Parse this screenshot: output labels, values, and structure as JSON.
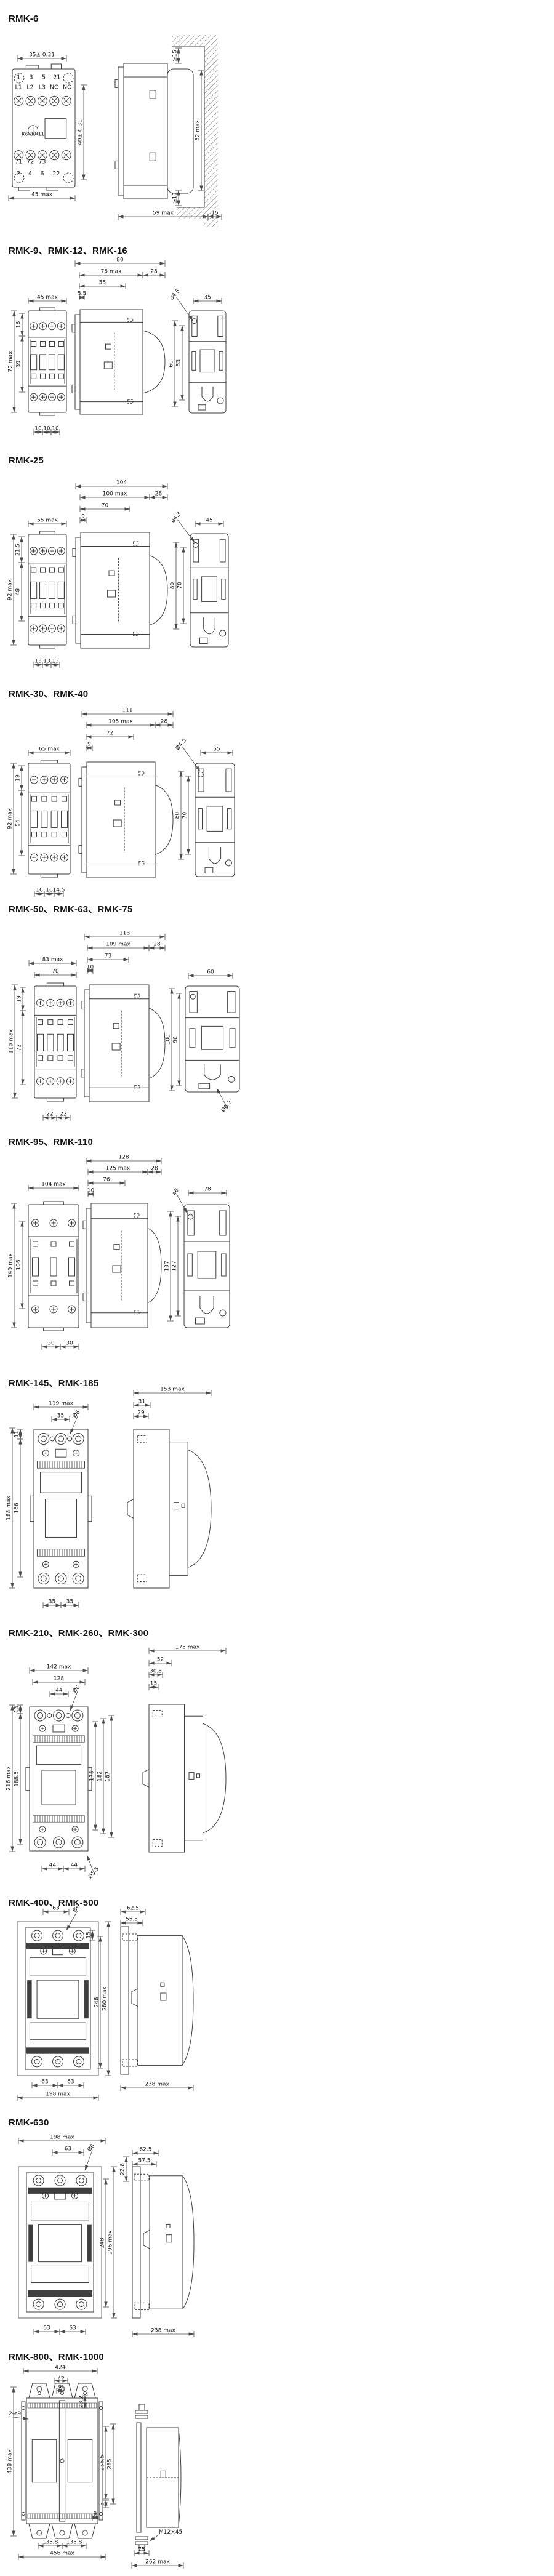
{
  "page": {
    "background": "#ffffff",
    "line_color": "#3d3d3d",
    "dim_color": "#4a4a4a",
    "text_color": "#1c1c1c",
    "title_color": "#141414"
  },
  "sections": [
    {
      "id": "rmk-6",
      "title": "RMK-6",
      "dims": [
        "35± 0.31",
        "40± 0.31",
        "45 max",
        "≥15",
        "52 max",
        "≥15",
        "59 max",
        "15"
      ],
      "notes": [
        "1",
        "3",
        "5",
        "21",
        "L1",
        "L2",
        "L3",
        "NC",
        "NO",
        "K6-30-11",
        "71",
        "72",
        "73",
        "2",
        "4",
        "6",
        "22"
      ]
    },
    {
      "id": "rmk-9-12-16",
      "title": "RMK-9、RMK-12、RMK-16",
      "dims": [
        "45 max",
        "72 max",
        "16",
        "39",
        "10",
        "10",
        "10",
        "80",
        "76 max",
        "28",
        "55",
        "5.5",
        "ø4.5",
        "35",
        "60",
        "53"
      ],
      "notes": []
    },
    {
      "id": "rmk-25",
      "title": "RMK-25",
      "dims": [
        "55 max",
        "92 max",
        "21.5",
        "48",
        "13",
        "13",
        "13",
        "104",
        "100 max",
        "28",
        "70",
        "9",
        "ø4.3",
        "45",
        "80",
        "70"
      ],
      "notes": []
    },
    {
      "id": "rmk-30-40",
      "title": "RMK-30、RMK-40",
      "dims": [
        "65 max",
        "92 max",
        "19",
        "54",
        "16",
        "16",
        "14.5",
        "111",
        "105 max",
        "28",
        "72",
        "9",
        "Ø4.5",
        "55",
        "80",
        "70"
      ],
      "notes": []
    },
    {
      "id": "rmk-50-63-75",
      "title": "RMK-50、RMK-63、RMK-75",
      "dims": [
        "83 max",
        "70",
        "110 max",
        "19",
        "72",
        "22",
        "22",
        "113",
        "109 max",
        "28",
        "73",
        "10",
        "60",
        "100",
        "90",
        "Ø6.2"
      ],
      "notes": []
    },
    {
      "id": "rmk-95-110",
      "title": "RMK-95、RMK-110",
      "dims": [
        "104 max",
        "149 max",
        "106",
        "30",
        "30",
        "128",
        "125 max",
        "28",
        "76",
        "10",
        "ø6",
        "78",
        "137",
        "127"
      ],
      "notes": []
    },
    {
      "id": "rmk-145-185",
      "title": "RMK-145、RMK-185",
      "dims": [
        "119 max",
        "35",
        "Ø6",
        "188 max",
        "11",
        "166",
        "35",
        "35",
        "153 max",
        "31",
        "29"
      ],
      "notes": []
    },
    {
      "id": "rmk-210-260-300",
      "title": "RMK-210、RMK-260、RMK-300",
      "dims": [
        "142 max",
        "128",
        "44",
        "Ø6",
        "216 max",
        "13",
        "188.5",
        "178",
        "182",
        "187",
        "44",
        "44",
        "Ø5.5",
        "175 max",
        "52",
        "30.5",
        "15"
      ],
      "notes": []
    },
    {
      "id": "rmk-400-500",
      "title": "RMK-400、RMK-500",
      "dims": [
        "63",
        "Ø6",
        "15",
        "248",
        "280 max",
        "63",
        "63",
        "198 max",
        "62.5",
        "55.5",
        "238 max"
      ],
      "notes": []
    },
    {
      "id": "rmk-630",
      "title": "RMK-630",
      "dims": [
        "198 max",
        "63",
        "Ø6",
        "22.8",
        "248",
        "296 max",
        "63",
        "63",
        "62.5",
        "57.5",
        "238 max"
      ],
      "notes": []
    },
    {
      "id": "rmk-800-1000",
      "title": "RMK-800、RMK-1000",
      "dims": [
        "424",
        "76",
        "30",
        "23.2",
        "2-ø9",
        "438 max",
        "256.5",
        "285",
        "3",
        "9",
        "135.8",
        "135.8",
        "456 max",
        "M12×45",
        "75",
        "262 max"
      ],
      "notes": []
    }
  ]
}
